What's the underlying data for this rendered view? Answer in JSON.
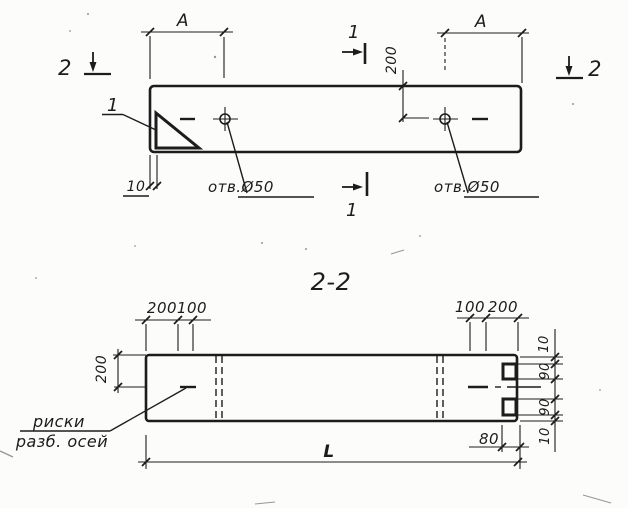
{
  "section_title": "2-2",
  "top": {
    "a_left": "A",
    "a_right": "A",
    "hole_offset": "200",
    "wall_10": "10",
    "hole_left": "отв.Ø50",
    "hole_right": "отв.Ø50",
    "detail_ref": "1",
    "cut1_top": "1",
    "cut1_bottom": "1",
    "cut2_left": "2",
    "cut2_right": "2"
  },
  "section": {
    "top_left_200": "200",
    "top_left_100": "100",
    "top_right_100": "100",
    "top_right_200": "200",
    "left_200": "200",
    "right_10_top": "10",
    "right_90_top": "90",
    "right_90_bottom": "90",
    "right_10_bottom": "10",
    "notch_80": "80",
    "length_L": "L",
    "note_line1": "риски",
    "note_line2": "разб. осей"
  },
  "colors": {
    "ink": "#1c1c1c",
    "paper": "#fcfcfb"
  }
}
